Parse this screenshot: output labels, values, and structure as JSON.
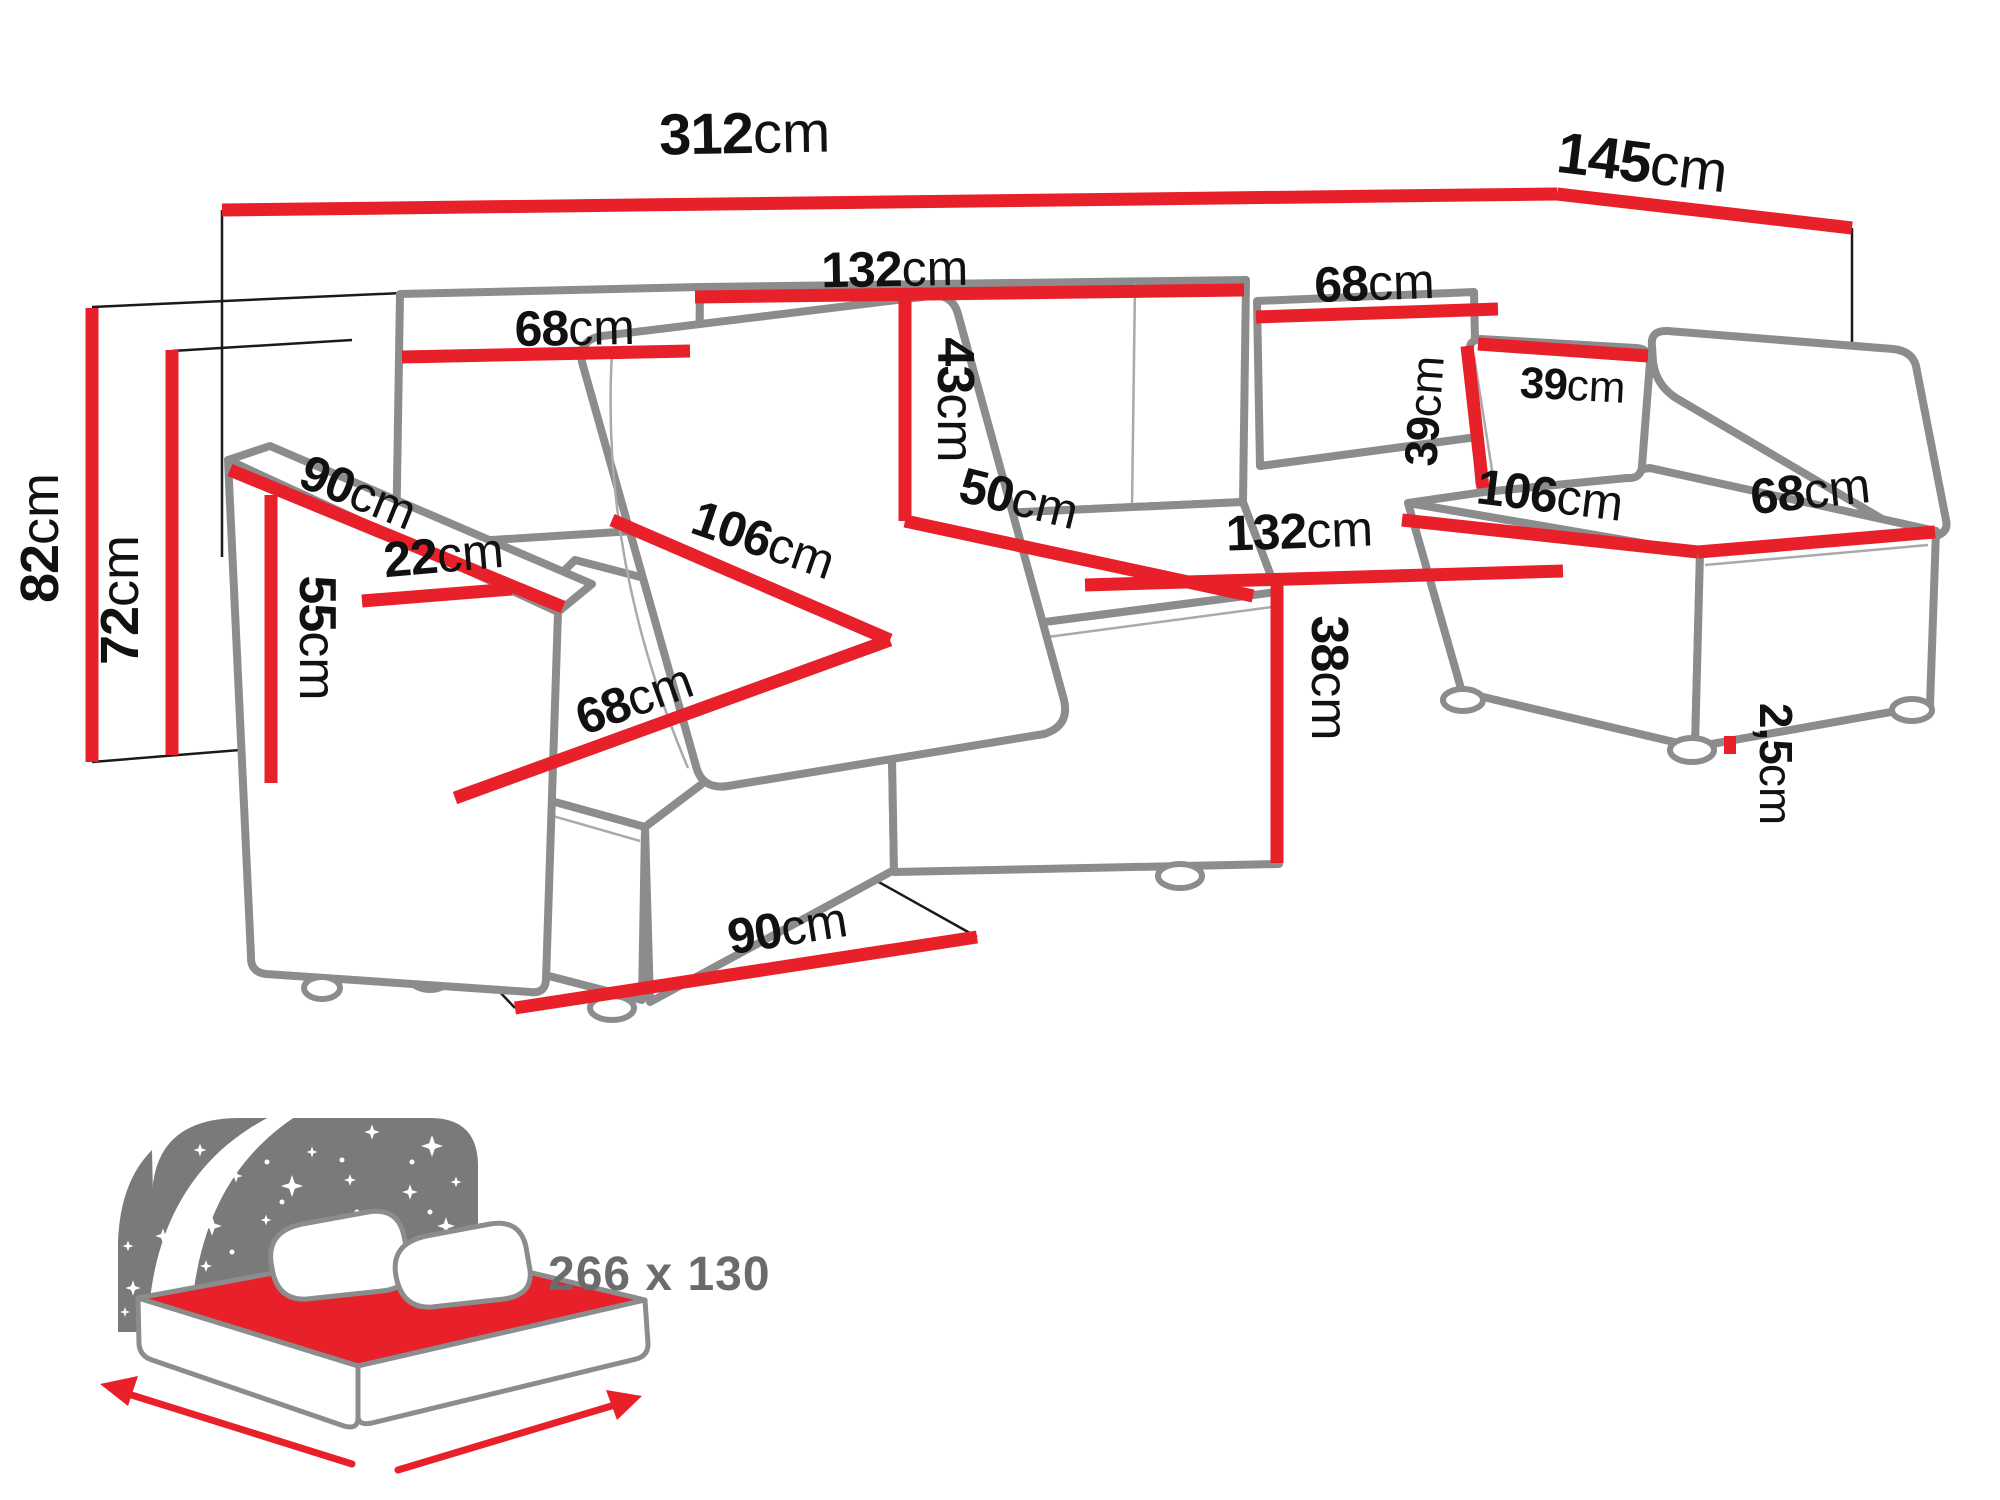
{
  "diagram": {
    "type": "sofa-dimension-diagram",
    "colors": {
      "dimension_red": "#e8202a",
      "outline_gray": "#8c8c8c",
      "label_black": "#111111",
      "icon_gray": "#7a7a7a",
      "icon_text_gray": "#6b6b6b"
    },
    "dims": {
      "total_width": {
        "value": "312",
        "unit": "cm"
      },
      "total_depth": {
        "value": "145",
        "unit": "cm"
      },
      "back_left_width": {
        "value": "68",
        "unit": "cm"
      },
      "back_mid_width": {
        "value": "132",
        "unit": "cm"
      },
      "back_right_width": {
        "value": "68",
        "unit": "cm"
      },
      "back_height": {
        "value": "43",
        "unit": "cm"
      },
      "mid_seat_depth": {
        "value": "50",
        "unit": "cm"
      },
      "mid_seat_width": {
        "value": "132",
        "unit": "cm"
      },
      "seat_height": {
        "value": "38",
        "unit": "cm"
      },
      "left_seat_depth": {
        "value": "106",
        "unit": "cm"
      },
      "left_seat_width": {
        "value": "68",
        "unit": "cm"
      },
      "right_seat_depth": {
        "value": "106",
        "unit": "cm"
      },
      "right_seat_width": {
        "value": "68",
        "unit": "cm"
      },
      "pillow_width": {
        "value": "39",
        "unit": "cm"
      },
      "pillow_height": {
        "value": "39",
        "unit": "cm"
      },
      "armrest_length": {
        "value": "90",
        "unit": "cm"
      },
      "armrest_width": {
        "value": "22",
        "unit": "cm"
      },
      "armrest_height": {
        "value": "55",
        "unit": "cm"
      },
      "total_height": {
        "value": "82",
        "unit": "cm"
      },
      "frame_height": {
        "value": "72",
        "unit": "cm"
      },
      "chaise_floor_depth": {
        "value": "90",
        "unit": "cm"
      },
      "leg_height": {
        "value": "2,5",
        "unit": "cm"
      }
    },
    "sleeping_area": {
      "label": "266 x 130"
    }
  }
}
